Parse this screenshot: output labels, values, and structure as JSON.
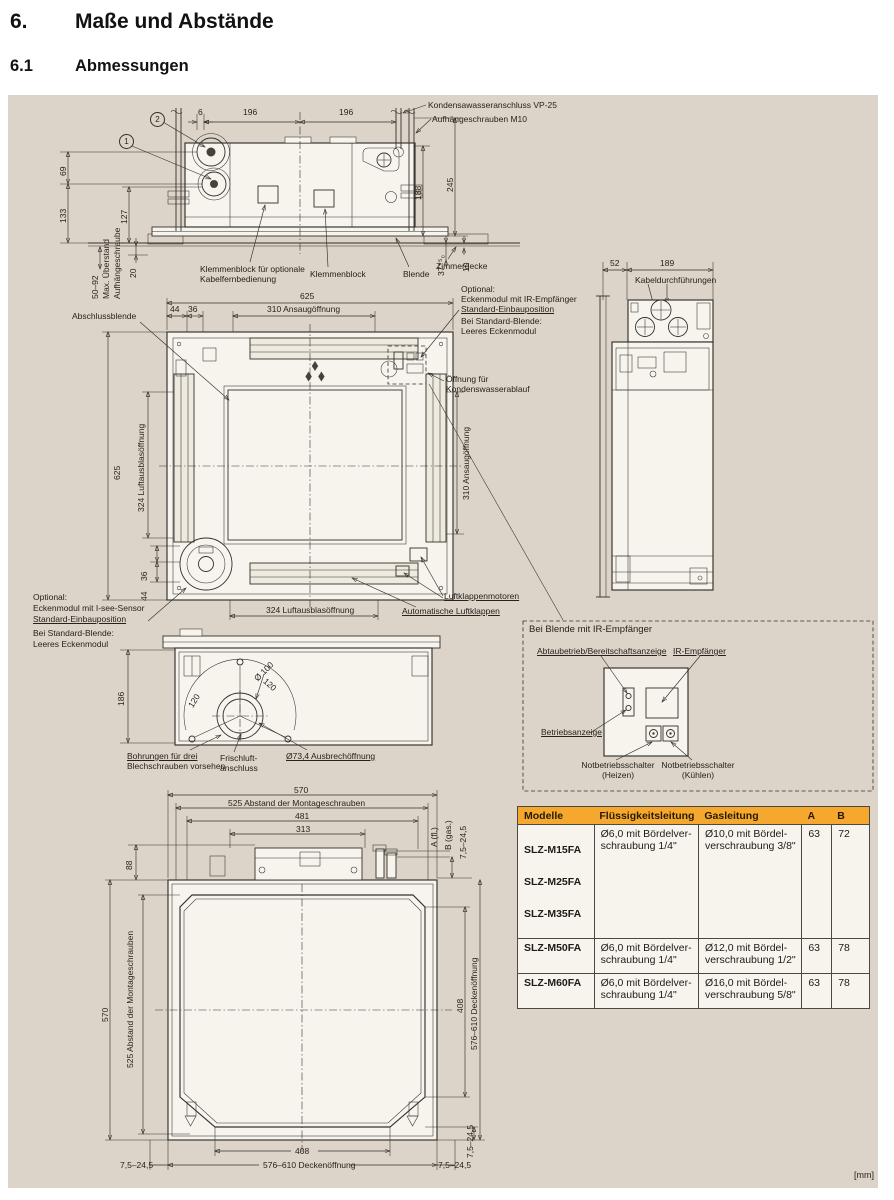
{
  "page": {
    "section_number": "6.",
    "section_title": "Maße und Abstände",
    "subsection_number": "6.1",
    "subsection_title": "Abmessungen",
    "unit_note": "[mm]"
  },
  "colors": {
    "table_header": "#F5A72E",
    "panel_bg": "#DCD4C8",
    "line": "#33302C"
  },
  "d1": {
    "callout1": "1",
    "callout2": "2",
    "dim6": "6",
    "dim196": "196",
    "kondensat": "Kondensawasseranschluss VP-25",
    "aufhaenge": "Aufhängeschrauben M10",
    "dim69": "69",
    "dim133": "133",
    "dim127": "127",
    "dim20": "20",
    "dim50_92": "50–92",
    "max_ueberstand": "Max. Überstand",
    "aufhaengeschraube": "Aufhängeschraube",
    "dim188": "188",
    "dim245": "245",
    "dim37": "37⁺⁵₀",
    "dim10": "10",
    "klemmen_opt": "Klemmenblock für optionale\nKabelfernbedienung",
    "klemmen": "Klemmenblock",
    "blende": "Blende",
    "zimmerdecke": "Zimmerdecke"
  },
  "d2": {
    "dim625": "625",
    "dim44": "44",
    "dim36": "36",
    "ansaug": "310 Ansaugöffnung",
    "ausblas": "324 Luftausblasöffnung",
    "abschlussblende": "Abschlussblende",
    "optional": "Optional:",
    "eckenmodul_ir": "Eckenmodul mit IR-Empfänger",
    "eckenmodul_isee": "Eckenmodul mit I-see-Sensor",
    "einbauposition": "Standard-Einbauposition",
    "bei_standard": "Bei Standard-Blende:",
    "leeres": "Leeres Eckenmodul",
    "oeffnung": "Öffnung für\nKondenswasserablauf",
    "luftklappenmotoren": "Luftklappenmotoren",
    "auto_klappen": "Automatische Luftklappen"
  },
  "d3": {
    "dim52": "52",
    "dim189": "189",
    "kabel": "Kabeldurchführungen"
  },
  "d4": {
    "dim186": "186",
    "d100": "Ø 100",
    "dim120": "120",
    "bohrungen1": "Bohrungen für drei",
    "bohrungen2": "Blechschrauben vorsehen",
    "frischluft": "Frischluft-\nanschluss",
    "ausbrech": "Ø73,4 Ausbrechöffnung"
  },
  "irbox": {
    "title": "Bei Blende mit IR-Empfänger",
    "abtau": "Abtaubetrieb/Bereitschaftsanzeige",
    "ir": "IR-Empfänger",
    "betrieb": "Betriebsanzeige",
    "not_heizen": "Notbetriebsschalter\n(Heizen)",
    "not_kuehlen": "Notbetriebsschalter\n(Kühlen)"
  },
  "d5": {
    "dim570": "570",
    "montage": "525 Abstand der Montageschrauben",
    "dim481": "481",
    "dim313": "313",
    "a_fl": "A (fl.)",
    "b_gas": "B (gas.)",
    "dim7524": "7,5–24,5",
    "dim88": "88",
    "dim408": "408",
    "decken": "576–610 Deckenöffnung"
  },
  "table": {
    "headers": [
      "Modelle",
      "Flüssigkeitsleitung",
      "Gasleitung",
      "A",
      "B"
    ],
    "rows": [
      {
        "models": [
          "SLZ-M15FA",
          "SLZ-M25FA",
          "SLZ-M35FA"
        ],
        "fluid": "Ø6,0 mit Bördelver-\nschraubung 1/4\"",
        "gas": "Ø10,0 mit Bördel-\nverschraubung 3/8\"",
        "a": "63",
        "b": "72"
      },
      {
        "models": [
          "SLZ-M50FA"
        ],
        "fluid": "Ø6,0 mit Bördelver-\nschraubung 1/4\"",
        "gas": "Ø12,0 mit Bördel-\nverschraubung 1/2\"",
        "a": "63",
        "b": "78"
      },
      {
        "models": [
          "SLZ-M60FA"
        ],
        "fluid": "Ø6,0 mit Bördelver-\nschraubung 1/4\"",
        "gas": "Ø16,0 mit Bördel-\nverschraubung 5/8\"",
        "a": "63",
        "b": "78"
      }
    ]
  }
}
